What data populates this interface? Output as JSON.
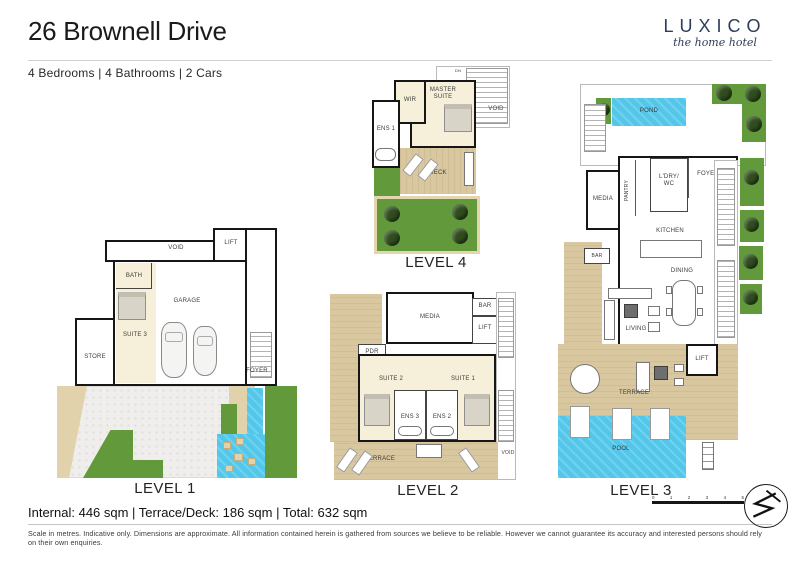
{
  "header": {
    "title": "26 Brownell Drive",
    "meta": "4 Bedrooms  |  4 Bathrooms  |  2 Cars",
    "logo_name": "LUXICO",
    "logo_tagline": "the home hotel"
  },
  "levels": {
    "l1": {
      "label": "LEVEL 1",
      "rooms": {
        "void": "VOID",
        "lift": "LIFT",
        "bath": "BATH",
        "suite3": "SUITE 3",
        "garage": "GARAGE",
        "store": "STORE",
        "foyer": "FOYER"
      }
    },
    "l2": {
      "label": "LEVEL 2",
      "rooms": {
        "media": "MEDIA",
        "bar": "BAR",
        "lift": "LIFT",
        "pdr": "PDR",
        "suite2": "SUITE 2",
        "suite1": "SUITE 1",
        "ens3": "ENS 3",
        "ens2": "ENS 2",
        "terrace": "TERRACE",
        "void": "VOID"
      }
    },
    "l3": {
      "label": "LEVEL 3",
      "rooms": {
        "pond": "POND",
        "media": "MEDIA",
        "pantry": "PANTRY",
        "ldry_wc": "L'DRY/\nWC",
        "foyer": "FOYER",
        "kitchen": "KITCHEN",
        "bar": "BAR",
        "dining": "DINING",
        "living": "LIVING",
        "lift": "LIFT",
        "terrace": "TERRACE",
        "pool": "POOL"
      }
    },
    "l4": {
      "label": "LEVEL 4",
      "rooms": {
        "dn": "DN",
        "wir": "WIR",
        "master": "MASTER\nSUITE",
        "ens1": "ENS 1",
        "void": "VOID",
        "deck": "DECK"
      }
    }
  },
  "footer": {
    "areas": "Internal:  446 sqm   |   Terrace/Deck:  186 sqm   |   Total: 632 sqm",
    "disclaimer": "Scale in metres.  Indicative only.  Dimensions are approximate.  All information contained herein is gathered from sources we believe to be reliable.  However we cannot guarantee its accuracy and interested persons should rely on their own enquiries.",
    "scale_ticks": [
      "0",
      "1",
      "2",
      "3",
      "4",
      "5"
    ]
  },
  "colors": {
    "pool": "#53c7ea",
    "lawn": "#61993b",
    "wood": "#d9c89f",
    "wall": "#161616",
    "brand_navy": "#2e3d59"
  }
}
